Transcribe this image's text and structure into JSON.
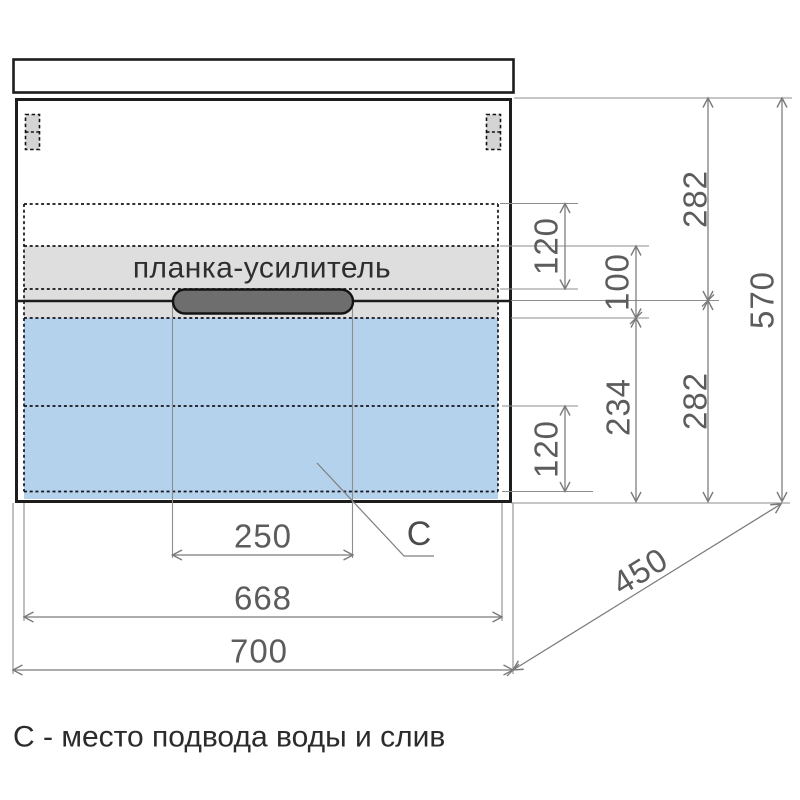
{
  "diagram": {
    "type": "furniture-dimension-drawing",
    "caption": "С - место подвода воды и слив",
    "reinforcement_label": "планка-усилитель",
    "drain_point_label": "С",
    "dims": {
      "overall_width": "700",
      "inner_width": "668",
      "handle_width": "250",
      "depth": "450",
      "overall_height": "570",
      "upper_section_height": "282",
      "lower_section_height": "282",
      "upper_offset": "120",
      "lower_offset": "120",
      "bar_offset": "100",
      "drawer_inner_height": "234"
    },
    "colors": {
      "outline": "#1d1d1d",
      "dimension_lines": "#7a7a7a",
      "drawer_zone_fill": "#b5d2ec",
      "reinforcement_fill": "#dedede",
      "handle_fill": "#6e6e6e",
      "text": "#2b2b2b"
    }
  }
}
